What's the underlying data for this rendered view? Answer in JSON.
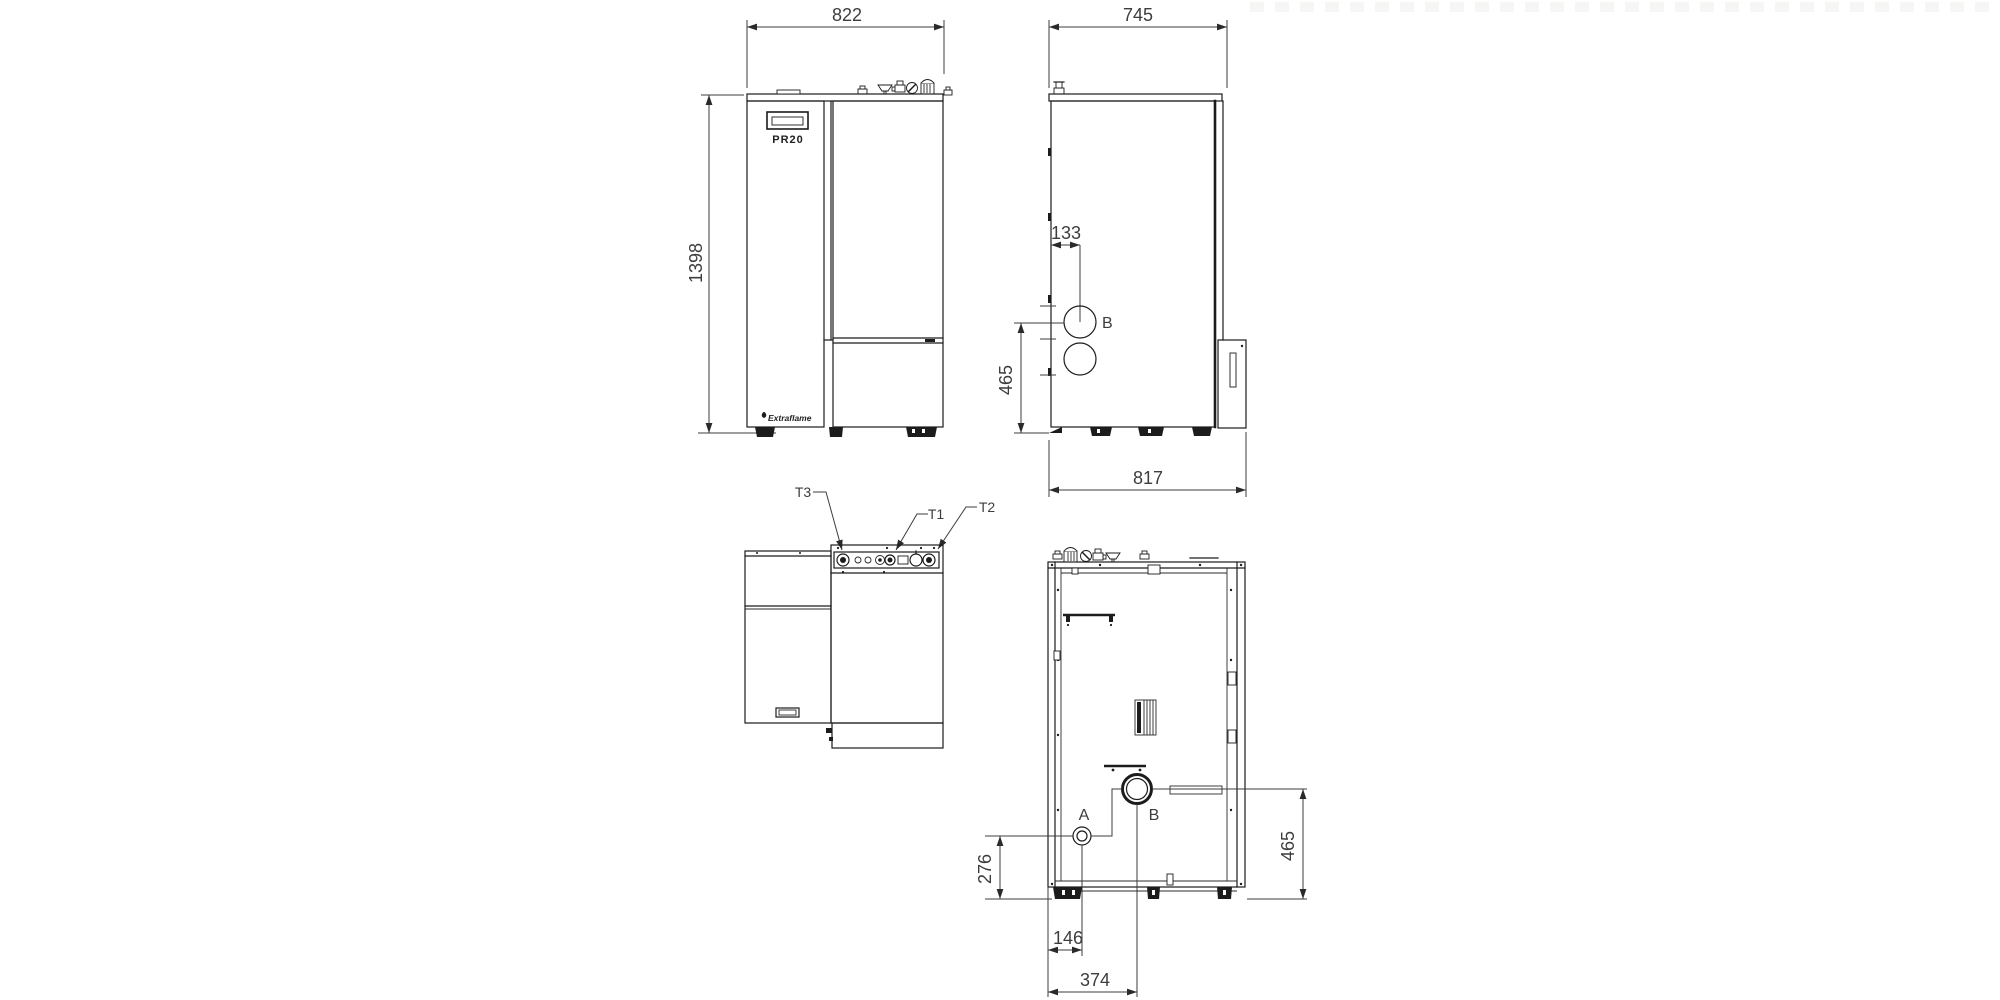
{
  "colors": {
    "line": "#1c1c1c",
    "dim_text": "#3d3d3d",
    "background": "#ffffff"
  },
  "front_view": {
    "width_mm": "822",
    "height_mm": "1398",
    "model": "PR20",
    "brand": "Extraflame"
  },
  "side_view": {
    "width_mm": "745",
    "flue_offset_mm": "133",
    "flue_height_mm": "465",
    "depth_mm": "817",
    "flue_label": "B"
  },
  "connections_view": {
    "t3": "T3",
    "t1": "T1",
    "t2": "T2"
  },
  "rear_view": {
    "drain_label": "A",
    "flue_label": "B",
    "drain_height_mm": "276",
    "flue_height_mm": "465",
    "drain_offset_mm": "146",
    "flue_offset_mm": "374"
  }
}
